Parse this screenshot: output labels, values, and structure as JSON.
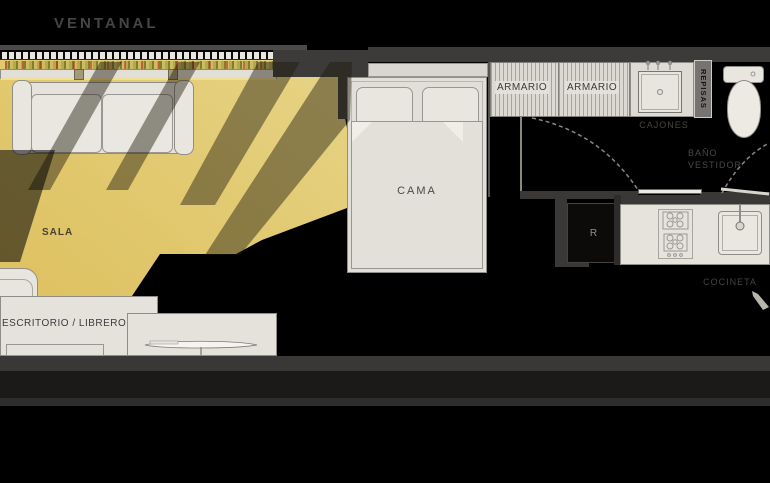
{
  "plan": {
    "title": "VENTANAL",
    "labels": {
      "ventanal": "VENTANAL",
      "sala": "SALA",
      "cama": "CAMA",
      "armario_left": "ARMARIO",
      "armario_right": "ARMARIO",
      "repisas": "REPISAS",
      "cajones": "CAJONES",
      "bano_line1": "BAÑO",
      "bano_line2": "VESTIDOR",
      "refrigerator": "R",
      "cocineta": "COCINETA",
      "escritorio": "ESCRITORIO / LIBRERO"
    },
    "colors": {
      "background": "#000000",
      "wall": "#3d3b39",
      "furniture": "#e6e2dc",
      "furniture_border": "#8f8d88",
      "sunlight": "#f5d977",
      "label": "#4a4846"
    }
  }
}
